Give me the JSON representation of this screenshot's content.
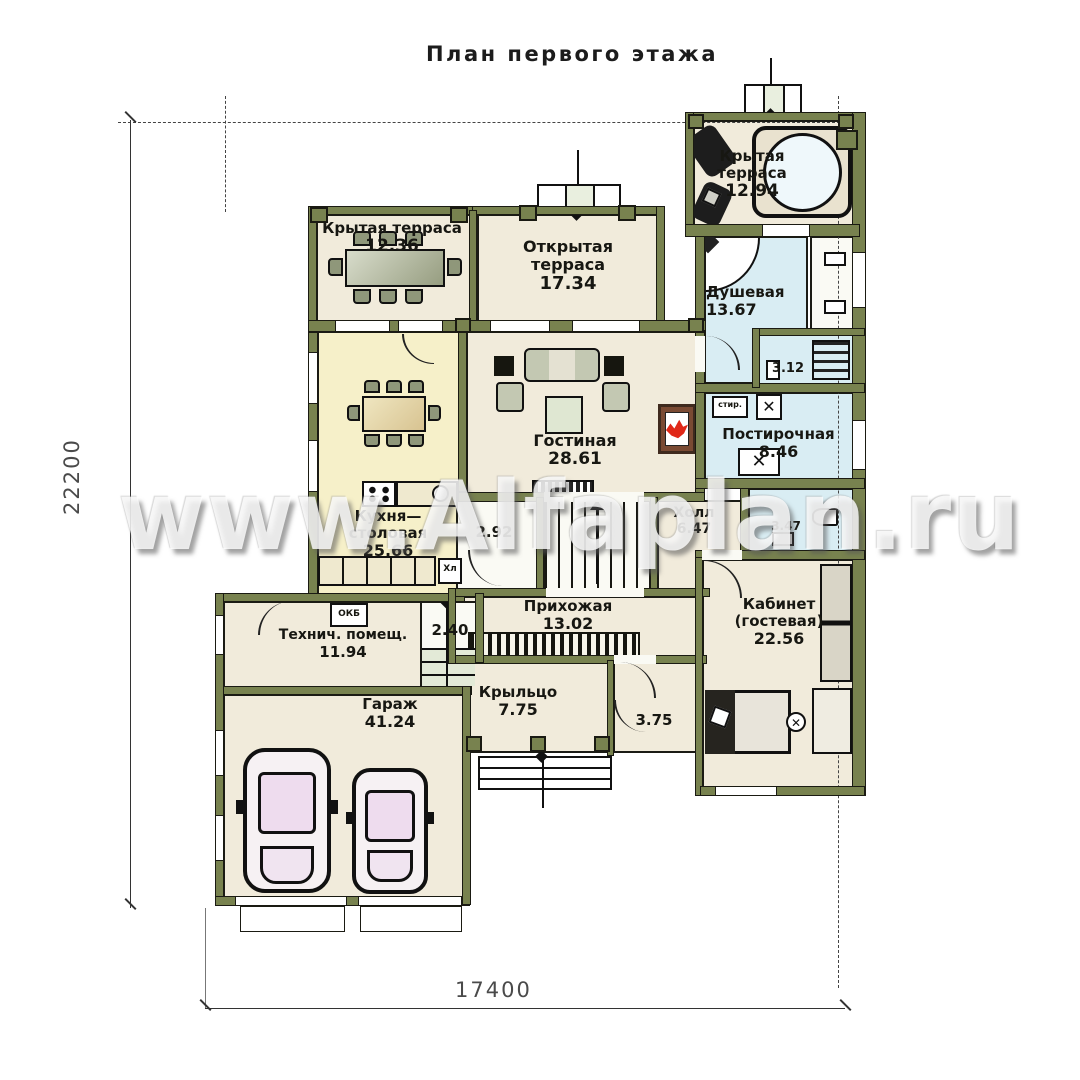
{
  "title": "План первого этажа",
  "watermark": "www.Alfaplan.ru",
  "dimensions": {
    "left_height": "22200",
    "bottom_width": "17400"
  },
  "rooms": {
    "terrace_tr": {
      "name": "Крытая терраса",
      "area": "12.94"
    },
    "terrace_tl": {
      "name": "Крытая терраса",
      "area": "12.36"
    },
    "terrace_open": {
      "name": "Открытая терраса",
      "area": "17.34"
    },
    "shower": {
      "name": "Душевая",
      "area": "13.67"
    },
    "sauna": {
      "area": "3.12"
    },
    "laundry": {
      "name": "Постирочная",
      "area": "8.46"
    },
    "living": {
      "name": "Гостиная",
      "area": "28.61"
    },
    "kitchen": {
      "name": "Кухня—столовая",
      "area": "25.66"
    },
    "hall": {
      "name": "Холл",
      "area": "6.47"
    },
    "pantry": {
      "area": "2.92"
    },
    "wc": {
      "area": "3.47"
    },
    "entry": {
      "name": "Прихожая",
      "area": "13.02"
    },
    "office": {
      "name": "Кабинет (гостевая)",
      "area": "22.56"
    },
    "tech": {
      "name": "Технич. помещ.",
      "area": "11.94"
    },
    "steps_in": {
      "area": "2.40"
    },
    "garage": {
      "name": "Гараж",
      "area": "41.24"
    },
    "porch": {
      "name": "Крыльцо",
      "area": "7.75"
    },
    "vestibule": {
      "area": "3.75"
    }
  },
  "small_labels": {
    "washer": "стир.",
    "fridge": "Хл",
    "boiler": "ОКБ"
  },
  "colors": {
    "wall": "#78824f",
    "floor": "#f1ebdb",
    "kitchen_floor": "#f6f0c9",
    "wet_floor": "#d9edf3",
    "flame": "#e02818",
    "car_glass": "#eedcee"
  }
}
